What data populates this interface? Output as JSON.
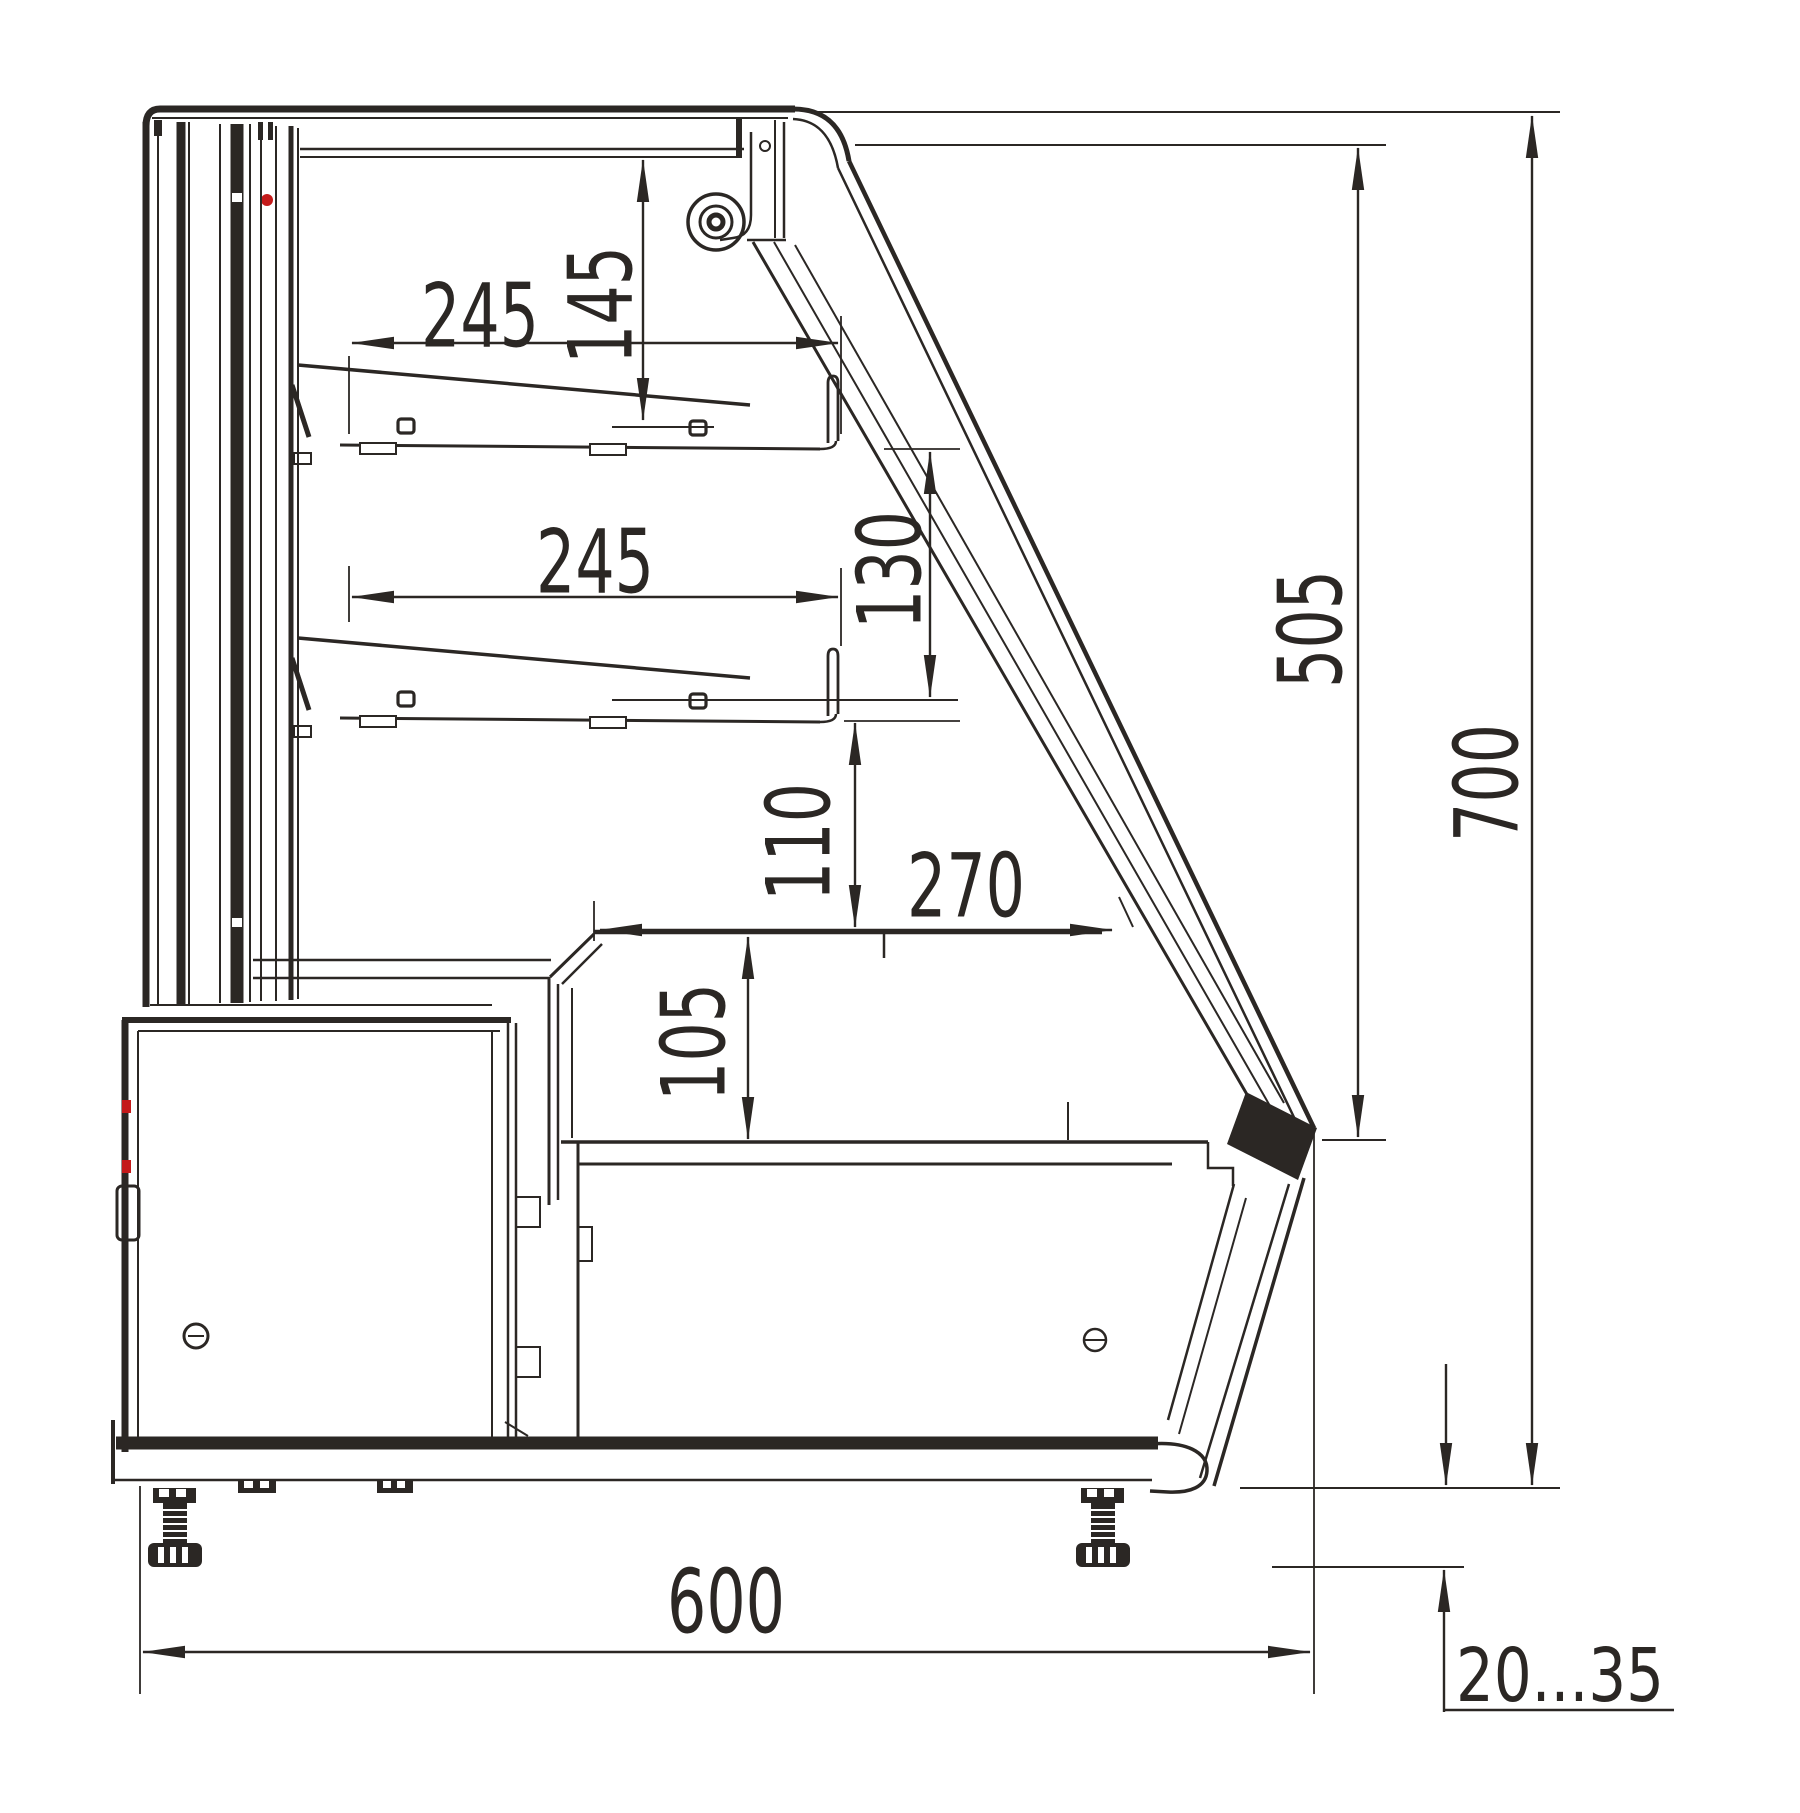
{
  "drawing": {
    "kind": "technical cross-section, refrigerated display case side view",
    "colors": {
      "line": "#2b2724",
      "accent_red": "#c41a1a",
      "background": "#ffffff"
    }
  },
  "labels": {
    "dim_shelf_upper_width": "245",
    "dim_canopy_to_upper_shelf": "145",
    "dim_shelf_lower_width": "245",
    "dim_shelf_spacing": "130",
    "dim_glass_opening_height": "505",
    "dim_overall_height": "700",
    "dim_shelf_to_counter": "110",
    "dim_counter_depth": "270",
    "dim_well_depth": "105",
    "dim_overall_depth": "600",
    "dim_foot_adjustment": "20...35"
  }
}
